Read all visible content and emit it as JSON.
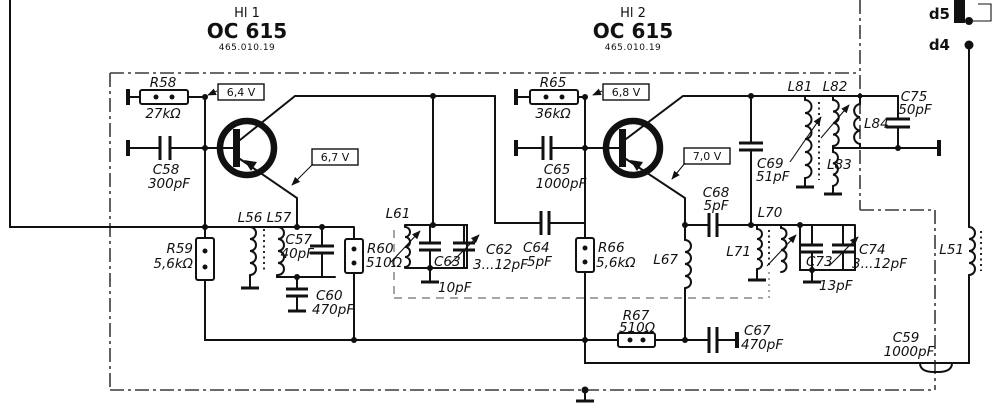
{
  "schematic": {
    "hl1": {
      "designator": "Hl 1",
      "type": "OC 615",
      "part_no": "465.010.19"
    },
    "hl2": {
      "designator": "Hl 2",
      "type": "OC 615",
      "part_no": "465.010.19"
    },
    "voltages": {
      "v_base1": "6,4 V",
      "v_emitter1": "6,7 V",
      "v_base2": "6,8 V",
      "v_emitter2": "7,0 V"
    },
    "terminals": {
      "d5": "d5",
      "d4": "d4"
    },
    "components": {
      "R58": {
        "ref": "R58",
        "value": "27kΩ"
      },
      "C58": {
        "ref": "C58",
        "value": "300pF"
      },
      "R59": {
        "ref": "R59",
        "value": "5,6kΩ"
      },
      "L56": {
        "ref": "L56"
      },
      "L57": {
        "ref": "L57"
      },
      "C57": {
        "ref": "C57",
        "value": "40pF"
      },
      "C60": {
        "ref": "C60",
        "value": "470pF"
      },
      "R60": {
        "ref": "R60",
        "value": "510Ω"
      },
      "L61": {
        "ref": "L61"
      },
      "C63": {
        "ref": "C63",
        "value": "10pF"
      },
      "C62": {
        "ref": "C62",
        "value": "3...12pF"
      },
      "C64": {
        "ref": "C64",
        "value": "5pF"
      },
      "R65": {
        "ref": "R65",
        "value": "36kΩ"
      },
      "C65": {
        "ref": "C65",
        "value": "1000pF"
      },
      "R66": {
        "ref": "R66",
        "value": "5,6kΩ"
      },
      "L67": {
        "ref": "L67"
      },
      "C68": {
        "ref": "C68",
        "value": "5pF"
      },
      "C69": {
        "ref": "C69",
        "value": "51pF"
      },
      "L71": {
        "ref": "L71"
      },
      "L70": {
        "ref": "L70"
      },
      "C73": {
        "ref": "C73",
        "value": "13pF"
      },
      "C74": {
        "ref": "C74",
        "value": "3...12pF"
      },
      "R67": {
        "ref": "R67",
        "value": "510Ω"
      },
      "C67": {
        "ref": "C67",
        "value": "470pF"
      },
      "L81": {
        "ref": "L81"
      },
      "L82": {
        "ref": "L82"
      },
      "L83": {
        "ref": "L83"
      },
      "L84": {
        "ref": "L84"
      },
      "C75": {
        "ref": "C75",
        "value": "50pF"
      },
      "L51": {
        "ref": "L51"
      },
      "C59": {
        "ref": "C59",
        "value": "1000pF"
      }
    }
  }
}
